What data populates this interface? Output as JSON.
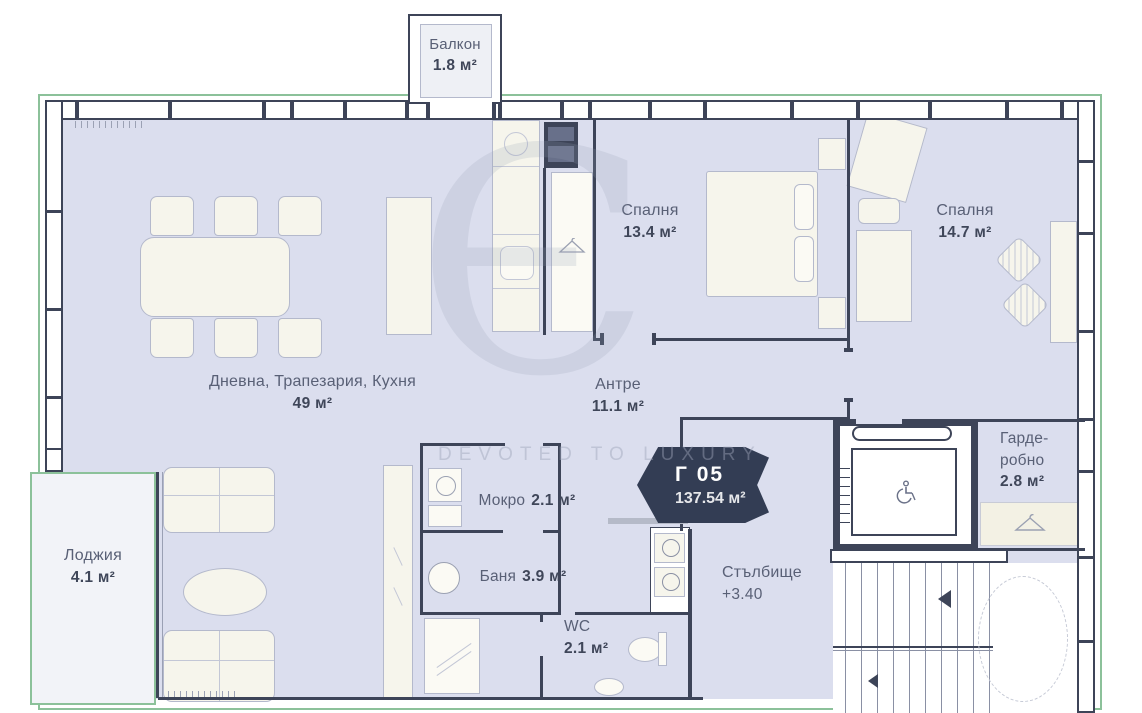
{
  "unit": {
    "code": "Г 05",
    "area": "137.54 м²"
  },
  "watermark": {
    "monogram": "Є",
    "tagline": "DEVOTED TO LUXURY"
  },
  "rooms": {
    "balcony": {
      "name": "Балкон",
      "area": "1.8 м²"
    },
    "living": {
      "name": "Дневна, Трапезария, Кухня",
      "area": "49 м²"
    },
    "bedroom1": {
      "name": "Спалня",
      "area": "13.4 м²"
    },
    "bedroom2": {
      "name": "Спалня",
      "area": "14.7 м²"
    },
    "hallway": {
      "name": "Антре",
      "area": "11.1 м²"
    },
    "wet_room": {
      "name": "Мокро",
      "area": "2.1 м²"
    },
    "bathroom": {
      "name": "Баня",
      "area": "3.9 м²"
    },
    "wc": {
      "name": "WC",
      "area": "2.1 м²"
    },
    "loggia": {
      "name": "Лоджия",
      "area": "4.1 м²"
    },
    "staircase": {
      "name": "Стълбище",
      "level": "+3.40"
    },
    "wardrobe": {
      "name": "Гарде-робно",
      "area": "2.8 м²"
    }
  },
  "colors": {
    "floor": "#dbdeee",
    "wall": "#3d4458",
    "furniture": "#f6f5ec",
    "boundary_green": "#8cc19a",
    "badge": "#333d54"
  }
}
